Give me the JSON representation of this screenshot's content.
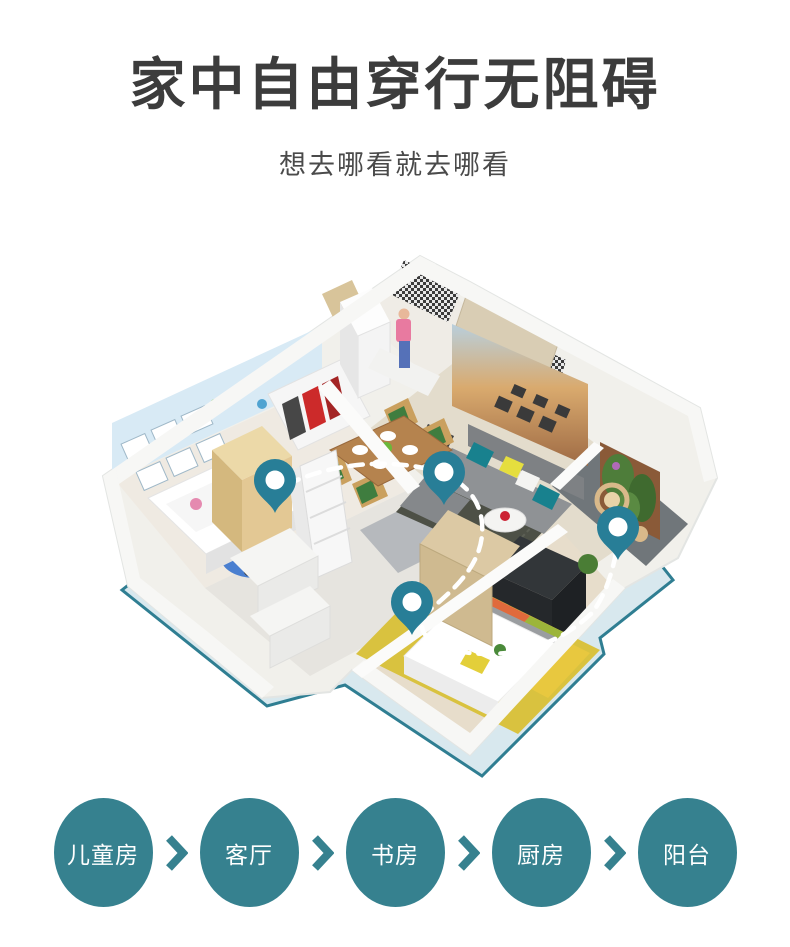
{
  "colors": {
    "accent_teal": "#36818F",
    "pin_teal": "#287E97",
    "plate_fill": "#D8E8EE",
    "plate_stroke": "#2F7E92",
    "route_white": "#FFFFFF",
    "title_gray": "#3C3C3C",
    "subtitle_gray": "#4A4A4A"
  },
  "header": {
    "title": "家中自由穿行无阻碍",
    "subtitle": "想去哪看就去哪看"
  },
  "floorplan": {
    "description": "isometric-3d-apartment-with-route",
    "pins": [
      {
        "name": "children-room-pin",
        "x": 275,
        "y": 315
      },
      {
        "name": "living-room-pin",
        "x": 444,
        "y": 307
      },
      {
        "name": "balcony-pin",
        "x": 618,
        "y": 362
      },
      {
        "name": "bedroom-pin",
        "x": 412,
        "y": 437
      }
    ]
  },
  "room_nav": {
    "items": [
      {
        "name": "children-room",
        "label": "儿童房"
      },
      {
        "name": "living-room",
        "label": "客厅"
      },
      {
        "name": "study",
        "label": "书房"
      },
      {
        "name": "kitchen",
        "label": "厨房"
      },
      {
        "name": "balcony",
        "label": "阳台"
      }
    ]
  }
}
